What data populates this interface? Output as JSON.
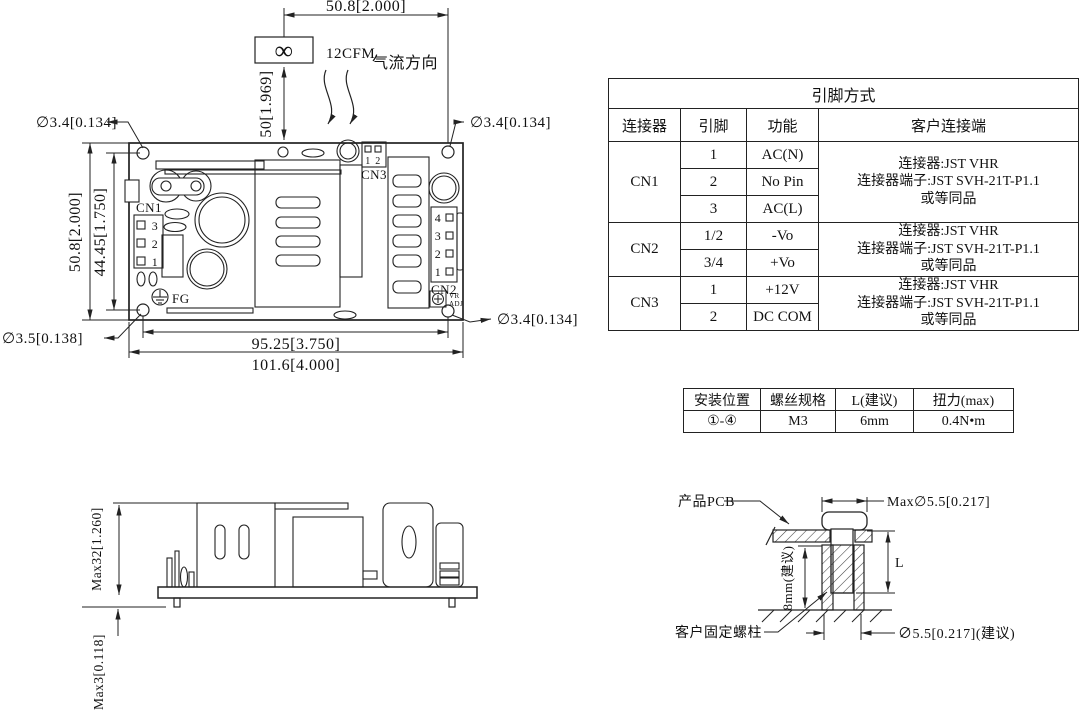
{
  "top_view": {
    "fan": {
      "symbol": "∞",
      "cfm": "12CFM",
      "airflow_label": "气流方向",
      "dim_offset": "50.8[2.000]",
      "dim_height": "50[1.969]"
    },
    "holes": {
      "top_left": "∅3.4[0.134]",
      "top_right": "∅3.4[0.134]",
      "bottom_left": "∅3.5[0.138]",
      "bottom_right": "∅3.4[0.134]"
    },
    "dims": {
      "height_outer": "50.8[2.000]",
      "height_holes": "44.45[1.750]",
      "width_holes": "95.25[3.750]",
      "width_outer": "101.6[4.000]"
    },
    "cn1": {
      "label": "CN1",
      "pins": [
        "3",
        "2",
        "1"
      ]
    },
    "cn2": {
      "label": "CN2",
      "pins": [
        "4",
        "3",
        "2",
        "1"
      ]
    },
    "cn3": {
      "label": "CN3",
      "pins": [
        "1",
        "2"
      ]
    },
    "fg_label": "FG",
    "vr_adj": {
      "line1": "VR",
      "line2": "ADJ"
    }
  },
  "pin_table": {
    "title": "引脚方式",
    "headers": {
      "connector": "连接器",
      "pin": "引脚",
      "function": "功能",
      "customer": "客户连接端"
    },
    "groups": [
      {
        "connector": "CN1",
        "rows": [
          {
            "pin": "1",
            "func": "AC(N)"
          },
          {
            "pin": "2",
            "func": "No Pin"
          },
          {
            "pin": "3",
            "func": "AC(L)"
          }
        ],
        "customer": [
          "连接器:JST VHR",
          "连接器端子:JST SVH-21T-P1.1",
          "或等同品"
        ]
      },
      {
        "connector": "CN2",
        "rows": [
          {
            "pin": "1/2",
            "func": "-Vo"
          },
          {
            "pin": "3/4",
            "func": "+Vo"
          }
        ],
        "customer": [
          "连接器:JST VHR",
          "连接器端子:JST SVH-21T-P1.1",
          "或等同品"
        ]
      },
      {
        "connector": "CN3",
        "rows": [
          {
            "pin": "1",
            "func": "+12V"
          },
          {
            "pin": "2",
            "func": "DC COM"
          }
        ],
        "customer": [
          "连接器:JST VHR",
          "连接器端子:JST SVH-21T-P1.1",
          "或等同品"
        ]
      }
    ]
  },
  "mount_table": {
    "headers": [
      "安装位置",
      "螺丝规格",
      "L(建议)",
      "扭力(max)"
    ],
    "row": [
      "①-④",
      "M3",
      "6mm",
      "0.4N•m"
    ]
  },
  "side_view": {
    "dim_height": "Max32[1.260]",
    "dim_pins": "Max3[0.118]"
  },
  "mount_detail": {
    "pcb_label": "产品PCB",
    "standoff_label": "客户固定螺柱",
    "dim_head": "Max∅5.5[0.217]",
    "dim_depth": "8mm(建议)",
    "dim_length": "L",
    "dim_hole": "∅5.5[0.217](建议)"
  }
}
